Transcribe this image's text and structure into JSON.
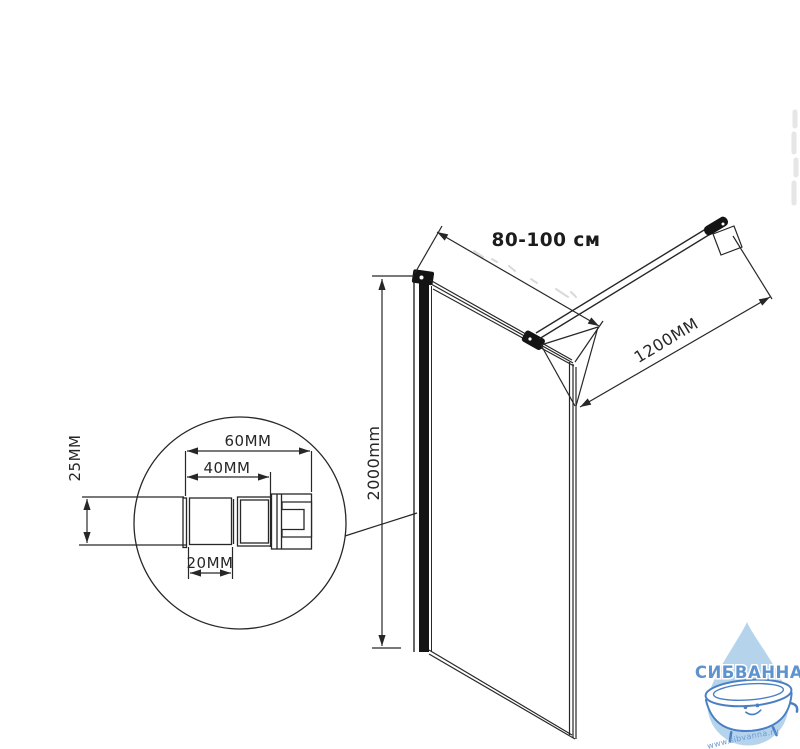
{
  "drawing": {
    "width_dimension_label": "80-100 см",
    "bar_length_label": "1200MM",
    "height_label": "2000mm",
    "detail": {
      "overall_width_label": "60MM",
      "inner_width_label": "40MM",
      "profile_width_label": "20MM",
      "profile_depth_label": "25MM"
    },
    "line_color": "#272727"
  },
  "watermark": {
    "brand": "СИБВАННА",
    "url": "www.sibvanna.ru",
    "brand_color": "#5e93cd",
    "drop_color": "#b5d4ec",
    "outline_color": "#4a80c3"
  }
}
